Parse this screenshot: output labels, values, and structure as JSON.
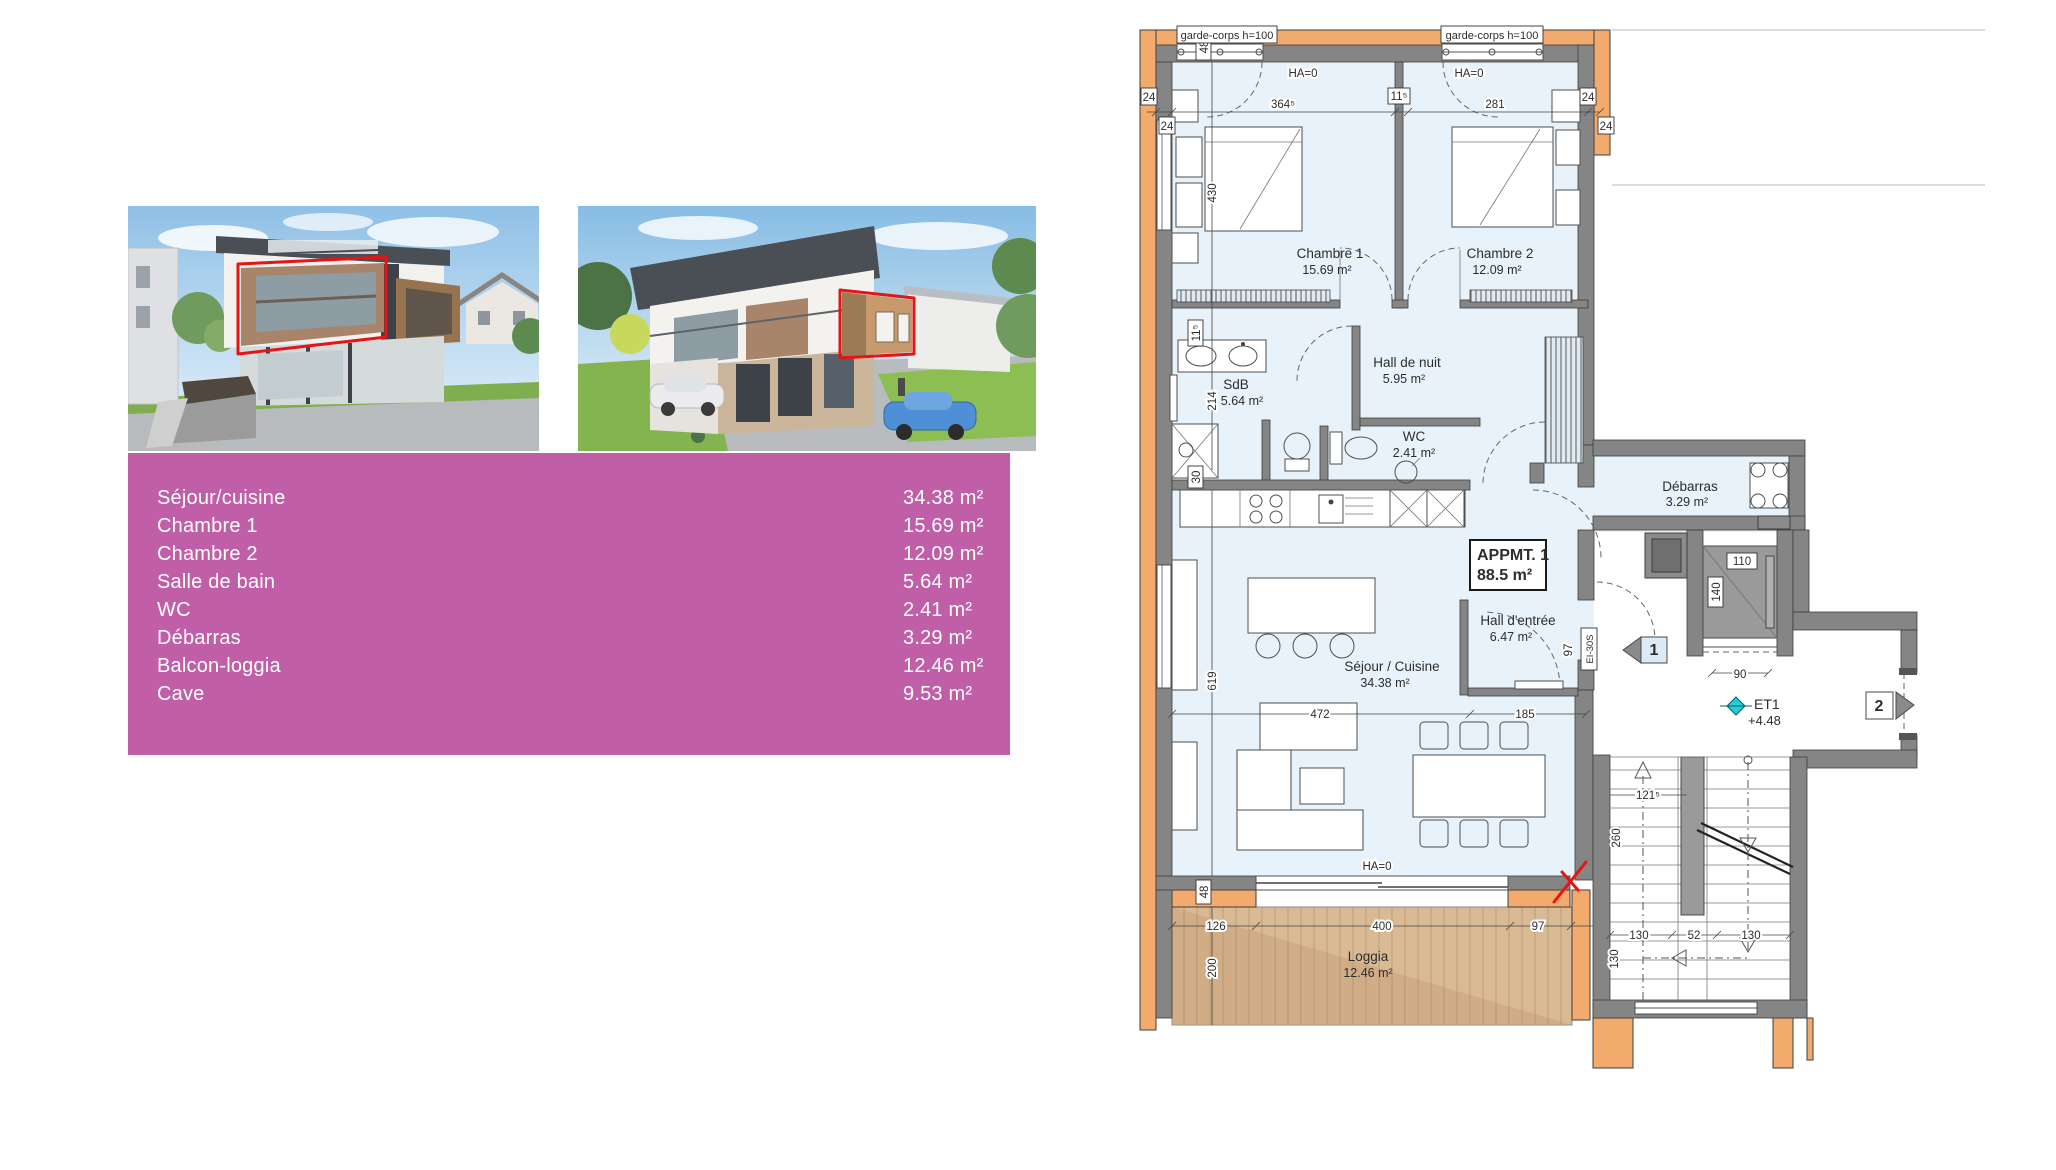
{
  "accent_color": "#c05fa8",
  "table": {
    "rows": [
      {
        "label": "Séjour/cuisine",
        "value": "34.38 m²"
      },
      {
        "label": "Chambre 1",
        "value": "15.69 m²"
      },
      {
        "label": "Chambre 2",
        "value": "12.09 m²"
      },
      {
        "label": "Salle de bain",
        "value": "5.64 m²"
      },
      {
        "label": "WC",
        "value": "2.41 m²"
      },
      {
        "label": "Débarras",
        "value": "3.29 m²"
      },
      {
        "label": "Balcon-loggia",
        "value": "12.46 m²"
      },
      {
        "label": "Cave",
        "value": "9.53 m²"
      }
    ]
  },
  "plan": {
    "apartment_box": {
      "line1": "APPMT. 1",
      "line2": "88.5 m²"
    },
    "rooms": {
      "chambre1": {
        "name": "Chambre 1",
        "area": "15.69 m²"
      },
      "chambre2": {
        "name": "Chambre 2",
        "area": "12.09 m²"
      },
      "hall_nuit": {
        "name": "Hall de nuit",
        "area": "5.95 m²"
      },
      "sdb": {
        "name": "SdB",
        "area": "5.64 m²"
      },
      "wc": {
        "name": "WC",
        "area": "2.41 m²"
      },
      "debarras": {
        "name": "Débarras",
        "area": "3.29 m²"
      },
      "sejour": {
        "name": "Séjour / Cuisine",
        "area": "34.38 m²"
      },
      "hall_entree": {
        "name": "Hall d'entrée",
        "area": "6.47 m²"
      },
      "loggia": {
        "name": "Loggia",
        "area": "12.46 m²"
      }
    },
    "annotations": {
      "garde_corps": "garde-corps h=100",
      "ha0": "HA=0",
      "ei30s": "EI-30S",
      "et1": "ET1",
      "level": "+4.48",
      "door1": "1",
      "door2": "2"
    },
    "dims": {
      "d24": "24",
      "d48": "48",
      "d364_5": "364⁵",
      "d11_5": "11⁵",
      "d281": "281",
      "d430": "430",
      "d214": "214",
      "d30": "30",
      "d619": "619",
      "d472": "472",
      "d185": "185",
      "d97": "97",
      "d110": "110",
      "d140": "140",
      "d90": "90",
      "d126": "126",
      "d400": "400",
      "d200": "200",
      "d121_5": "121⁵",
      "d260": "260",
      "d130": "130",
      "d52": "52"
    }
  }
}
